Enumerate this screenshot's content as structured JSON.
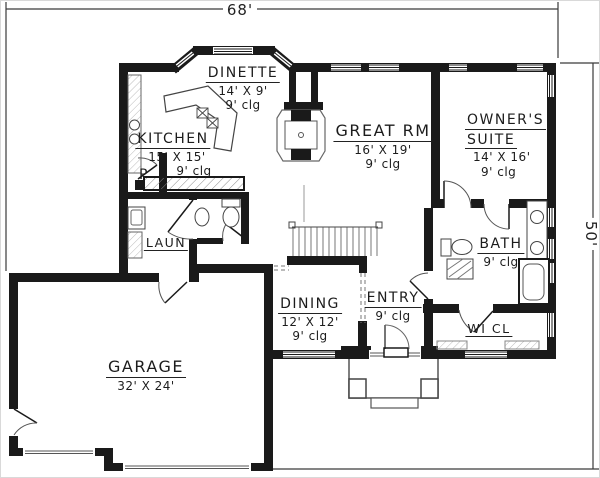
{
  "dimensions": {
    "width_label": "68'",
    "height_label": "50'"
  },
  "rooms": {
    "dinette": {
      "name": "DINETTE",
      "size": "14' X 9'",
      "ceiling": "9' clg"
    },
    "kitchen": {
      "name": "KITCHEN",
      "size": "15' X 15'",
      "ceiling": "9' clg"
    },
    "great_room": {
      "name": "GREAT RM",
      "size": "16' X 19'",
      "ceiling": "9' clg"
    },
    "owners_suite": {
      "name_line1": "OWNER'S",
      "name_line2": "SUITE",
      "size": "14' X 16'",
      "ceiling": "9' clg"
    },
    "laundry": {
      "name": "LAUN"
    },
    "pantry": {
      "name": "P"
    },
    "bath": {
      "name": "BATH",
      "ceiling": "9' clg"
    },
    "entry": {
      "name": "ENTRY",
      "ceiling": "9' clg"
    },
    "dining": {
      "name": "DINING",
      "size": "12' X 12'",
      "ceiling": "9' clg"
    },
    "walk_in_closet": {
      "name": "WI CL"
    },
    "garage": {
      "name": "GARAGE",
      "size": "32' X 24'"
    }
  },
  "colors": {
    "wall": "#1a1a1a",
    "line": "#3c3c3c",
    "background": "#ffffff"
  }
}
